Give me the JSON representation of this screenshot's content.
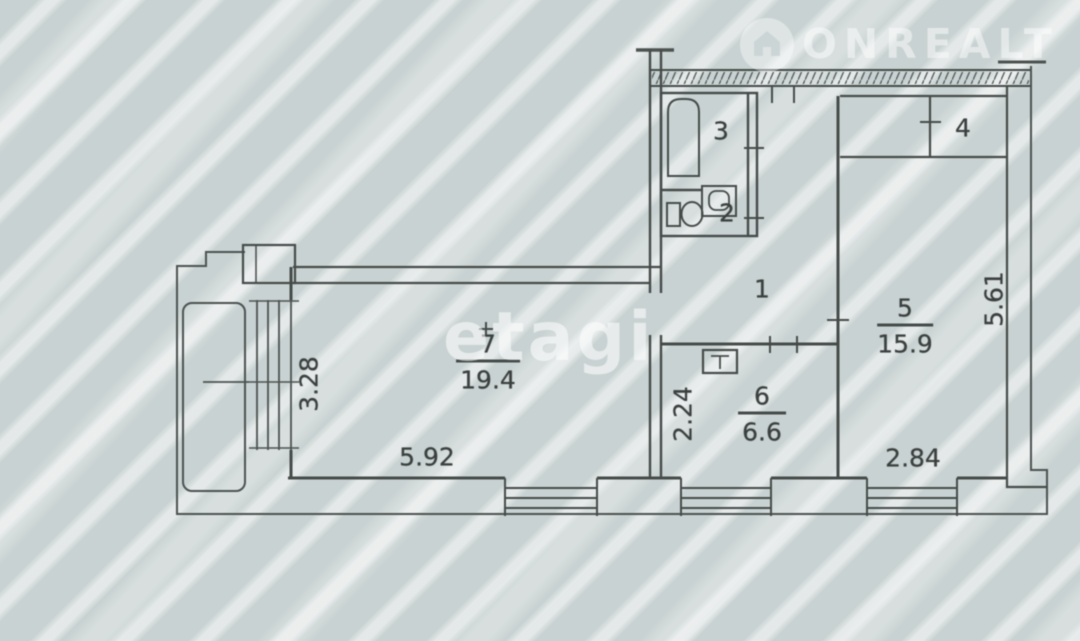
{
  "watermarks": {
    "logo_text": "ONREALT",
    "agency": "etagi"
  },
  "rooms": {
    "hall": {
      "number": "1"
    },
    "wc": {
      "number": "2"
    },
    "bathroom": {
      "number": "3"
    },
    "closet": {
      "number": "4"
    },
    "bedroom": {
      "number": "5",
      "area": "15.9"
    },
    "kitchen": {
      "number": "6",
      "area": "6.6"
    },
    "living_room": {
      "number": "7",
      "area": "19.4"
    }
  },
  "dimensions": {
    "balcony_depth": "3.28",
    "living_room_width": "5.92",
    "kitchen_width": "2.24",
    "bedroom_width": "2.84",
    "bedroom_depth": "5.61"
  },
  "colors": {
    "background": "#c9d2d2",
    "stripe": "#ffffff",
    "line": "#454b49",
    "watermark": "#ffffff"
  }
}
